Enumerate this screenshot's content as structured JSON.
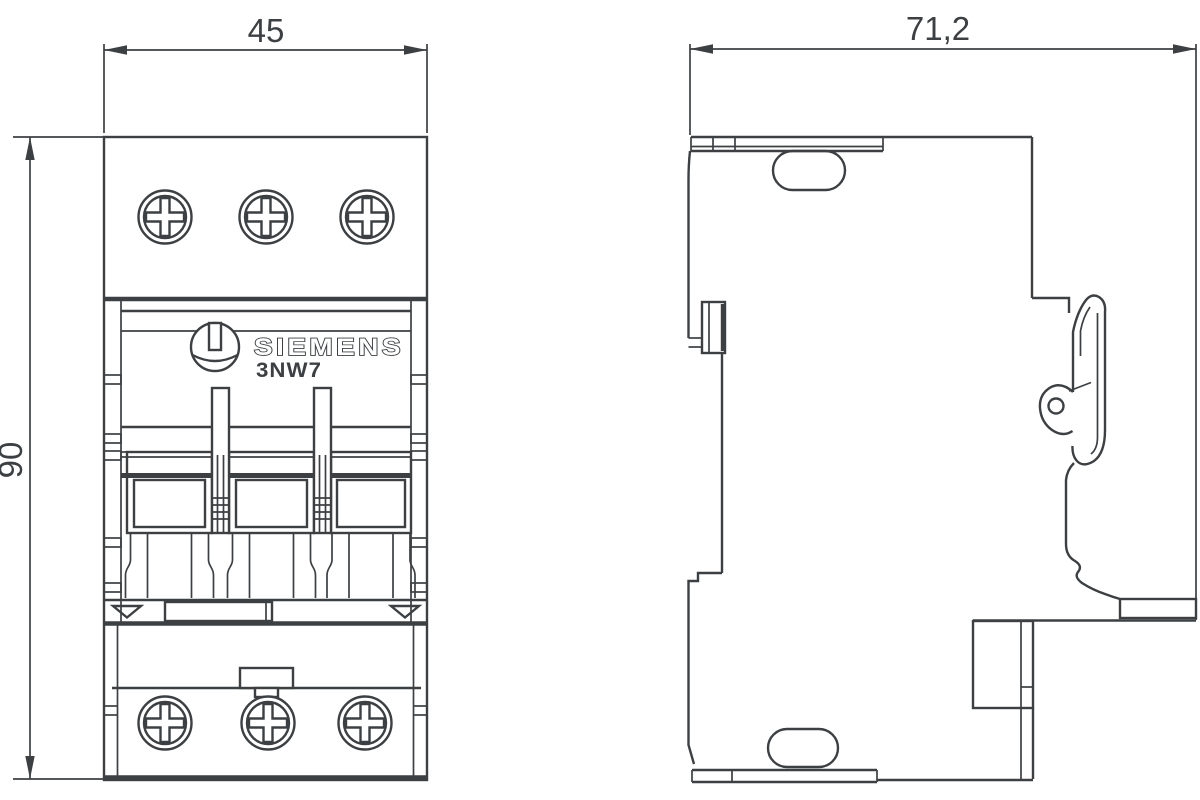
{
  "drawing": {
    "brand_label": "SIEMENS",
    "model_label": "3NW7",
    "dimensions": {
      "front_width_mm": "45",
      "front_height_mm": "90",
      "side_depth_mm": "71,2"
    },
    "colors": {
      "line": "#3c4043",
      "background": "#ffffff"
    }
  }
}
